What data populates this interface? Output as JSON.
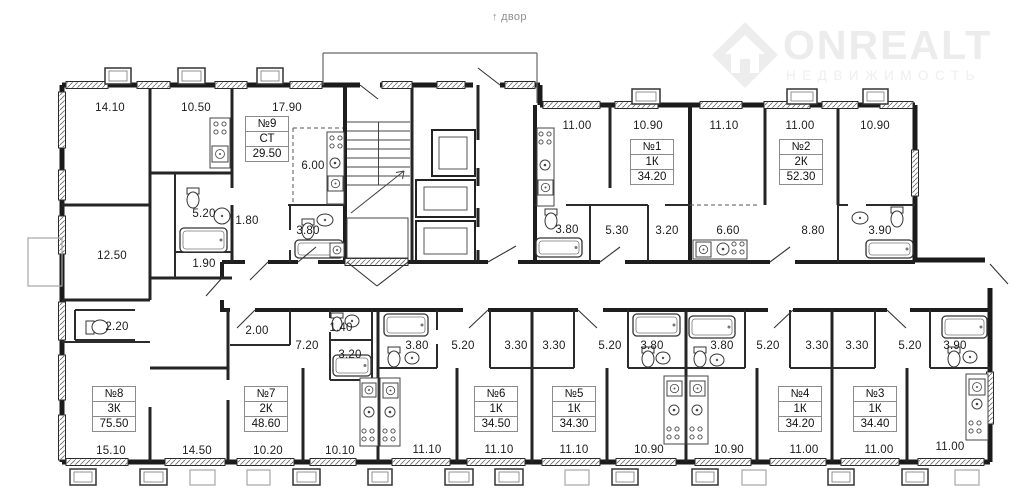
{
  "header": {
    "arrow": "↑",
    "courtyard_label": "двор"
  },
  "watermark": {
    "brand": "ONREALT",
    "subtitle": "НЕДВИЖИМОСТЬ"
  },
  "apartments": [
    {
      "number": "№9",
      "type": "СТ",
      "area": "29.50",
      "x": 245,
      "y": 116
    },
    {
      "number": "№1",
      "type": "1К",
      "area": "34.20",
      "x": 630,
      "y": 139
    },
    {
      "number": "№2",
      "type": "2К",
      "area": "52.30",
      "x": 779,
      "y": 139
    },
    {
      "number": "№8",
      "type": "3К",
      "area": "75.50",
      "x": 92,
      "y": 386
    },
    {
      "number": "№7",
      "type": "2К",
      "area": "48.60",
      "x": 244,
      "y": 386
    },
    {
      "number": "№6",
      "type": "1К",
      "area": "34.50",
      "x": 474,
      "y": 386
    },
    {
      "number": "№5",
      "type": "1К",
      "area": "34.30",
      "x": 552,
      "y": 386
    },
    {
      "number": "№4",
      "type": "1К",
      "area": "34.20",
      "x": 778,
      "y": 386
    },
    {
      "number": "№3",
      "type": "1К",
      "area": "34.40",
      "x": 853,
      "y": 386
    }
  ],
  "room_labels": [
    {
      "text": "14.10",
      "x": 110,
      "y": 108
    },
    {
      "text": "10.50",
      "x": 196,
      "y": 108
    },
    {
      "text": "17.90",
      "x": 287,
      "y": 108
    },
    {
      "text": "6.00",
      "x": 313,
      "y": 166
    },
    {
      "text": "5.20",
      "x": 204,
      "y": 214
    },
    {
      "text": "1.80",
      "x": 247,
      "y": 221
    },
    {
      "text": "3.80",
      "x": 308,
      "y": 231
    },
    {
      "text": "1.90",
      "x": 204,
      "y": 264
    },
    {
      "text": "12.50",
      "x": 112,
      "y": 256
    },
    {
      "text": "2.20",
      "x": 117,
      "y": 327
    },
    {
      "text": "11.00",
      "x": 577,
      "y": 126
    },
    {
      "text": "10.90",
      "x": 648,
      "y": 126
    },
    {
      "text": "11.10",
      "x": 724,
      "y": 126
    },
    {
      "text": "11.00",
      "x": 800,
      "y": 126
    },
    {
      "text": "10.90",
      "x": 875,
      "y": 126
    },
    {
      "text": "3.80",
      "x": 567,
      "y": 230
    },
    {
      "text": "5.30",
      "x": 617,
      "y": 231
    },
    {
      "text": "3.20",
      "x": 667,
      "y": 231
    },
    {
      "text": "6.60",
      "x": 728,
      "y": 231
    },
    {
      "text": "8.80",
      "x": 813,
      "y": 231
    },
    {
      "text": "3.90",
      "x": 880,
      "y": 231
    },
    {
      "text": "2.00",
      "x": 257,
      "y": 331
    },
    {
      "text": "7.20",
      "x": 307,
      "y": 346
    },
    {
      "text": "1.40",
      "x": 341,
      "y": 328
    },
    {
      "text": "3.20",
      "x": 350,
      "y": 355
    },
    {
      "text": "3.80",
      "x": 417,
      "y": 346
    },
    {
      "text": "5.20",
      "x": 463,
      "y": 346
    },
    {
      "text": "3.30",
      "x": 516,
      "y": 346
    },
    {
      "text": "3.30",
      "x": 554,
      "y": 346
    },
    {
      "text": "5.20",
      "x": 610,
      "y": 346
    },
    {
      "text": "3.80",
      "x": 652,
      "y": 346
    },
    {
      "text": "3.80",
      "x": 722,
      "y": 346
    },
    {
      "text": "5.20",
      "x": 768,
      "y": 346
    },
    {
      "text": "3.30",
      "x": 817,
      "y": 346
    },
    {
      "text": "3.30",
      "x": 857,
      "y": 346
    },
    {
      "text": "5.20",
      "x": 910,
      "y": 346
    },
    {
      "text": "3.90",
      "x": 955,
      "y": 346
    },
    {
      "text": "15.10",
      "x": 111,
      "y": 451
    },
    {
      "text": "14.50",
      "x": 197,
      "y": 451
    },
    {
      "text": "10.20",
      "x": 268,
      "y": 451
    },
    {
      "text": "10.10",
      "x": 340,
      "y": 451
    },
    {
      "text": "11.10",
      "x": 427,
      "y": 450
    },
    {
      "text": "11.10",
      "x": 499,
      "y": 450
    },
    {
      "text": "11.10",
      "x": 574,
      "y": 450
    },
    {
      "text": "10.90",
      "x": 649,
      "y": 450
    },
    {
      "text": "10.90",
      "x": 729,
      "y": 450
    },
    {
      "text": "11.00",
      "x": 804,
      "y": 450
    },
    {
      "text": "11.00",
      "x": 879,
      "y": 450
    },
    {
      "text": "11.00",
      "x": 950,
      "y": 447
    }
  ]
}
